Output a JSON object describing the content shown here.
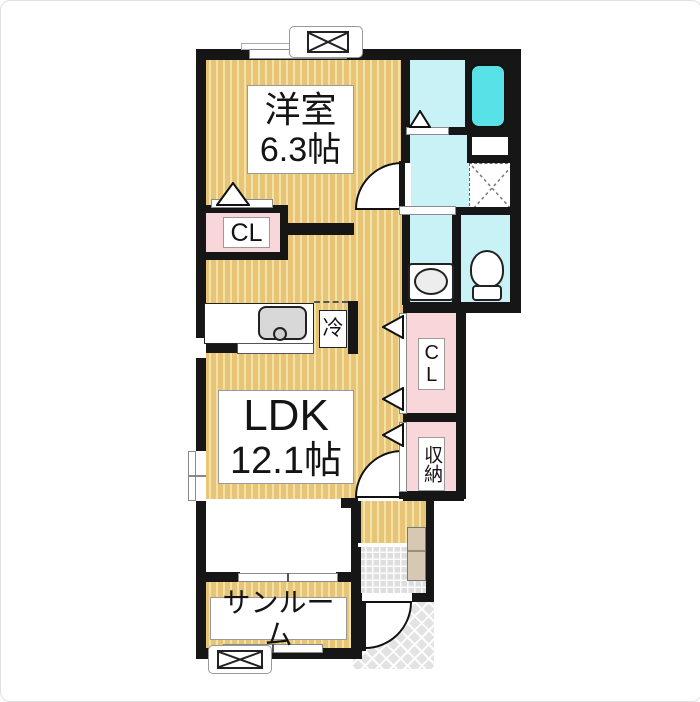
{
  "plan": {
    "title": "1LDK floor plan",
    "rooms": {
      "yoshitsu": {
        "name": "洋室",
        "size": "6.3帖"
      },
      "ldk": {
        "name": "LDK",
        "size": "12.1帖"
      },
      "sunroom": {
        "name": "サンルーム"
      },
      "closet_left": {
        "label": "CL"
      },
      "closet_right": {
        "label": "CL"
      },
      "storage": {
        "label": "収納"
      },
      "fridge": {
        "label": "冷"
      }
    },
    "colors": {
      "floor_wood": "#e7c476",
      "floor_wood_stripe": "#f3e2a7",
      "closet_pink": "#f8d6da",
      "wet_area_cyan": "#c9f2f6",
      "bathtub_cyan": "#58e2e8",
      "wall_black": "#161616",
      "entrance_tile_gray": "#dedede"
    }
  }
}
